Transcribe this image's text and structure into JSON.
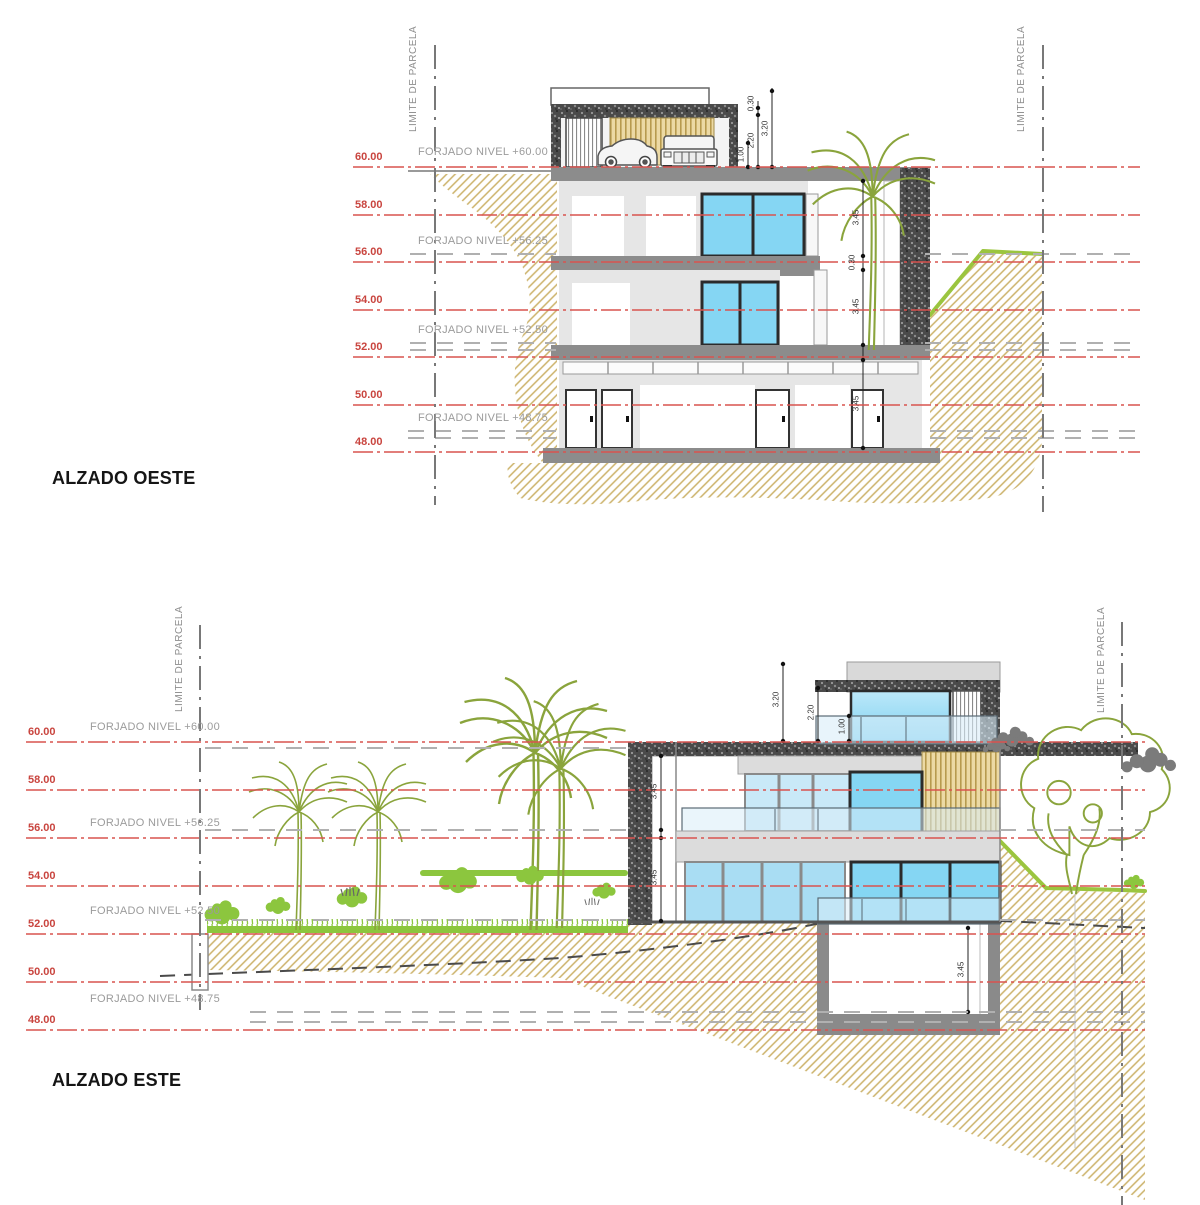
{
  "sheet": {
    "type": "architectural-elevations",
    "colors": {
      "level_line_red": "#d9534f",
      "level_text_red": "#c9453f",
      "forjado_text_gray": "#9b9b9b",
      "parcel_line_gray": "#787878",
      "earth_hatch": "#c9b268",
      "vegetation_outline": "#8aa43c",
      "vegetation_bright": "#8cc63e",
      "glass_blue": "#85d6f3",
      "glass_pale": "#d8edf8",
      "wall_speckle_dark": "#4a4a4a",
      "wall_gray": "#8c8c8c",
      "wood_slat": "#b79a4e"
    }
  },
  "oeste": {
    "title": "ALZADO OESTE",
    "parcel_label": "LIMITE DE PARCELA",
    "levels": [
      "60.00",
      "58.00",
      "56.00",
      "54.00",
      "52.00",
      "50.00",
      "48.00"
    ],
    "forjado": [
      "FORJADO NIVEL +60.00",
      "FORJADO NIVEL +56.25",
      "FORJADO NIVEL +52.50",
      "FORJADO NIVEL +48.75"
    ],
    "roof_dims": [
      "1.00",
      "2.20",
      "0.30",
      "3.20"
    ],
    "interior_dims": [
      "3.45",
      "0.30",
      "3.45",
      "3.45"
    ]
  },
  "este": {
    "title": "ALZADO ESTE",
    "parcel_label": "LIMITE DE PARCELA",
    "levels": [
      "60.00",
      "58.00",
      "56.00",
      "54.00",
      "52.00",
      "50.00",
      "48.00"
    ],
    "forjado": [
      "FORJADO NIVEL +60.00",
      "FORJADO NIVEL +56.25",
      "FORJADO NIVEL +52.50",
      "FORJADO NIVEL +48.75"
    ],
    "roof_dims": [
      "3.20",
      "2.20",
      "1.00"
    ],
    "left_dims": [
      "3.45",
      "3.45"
    ],
    "basement_dim": "3.45"
  }
}
